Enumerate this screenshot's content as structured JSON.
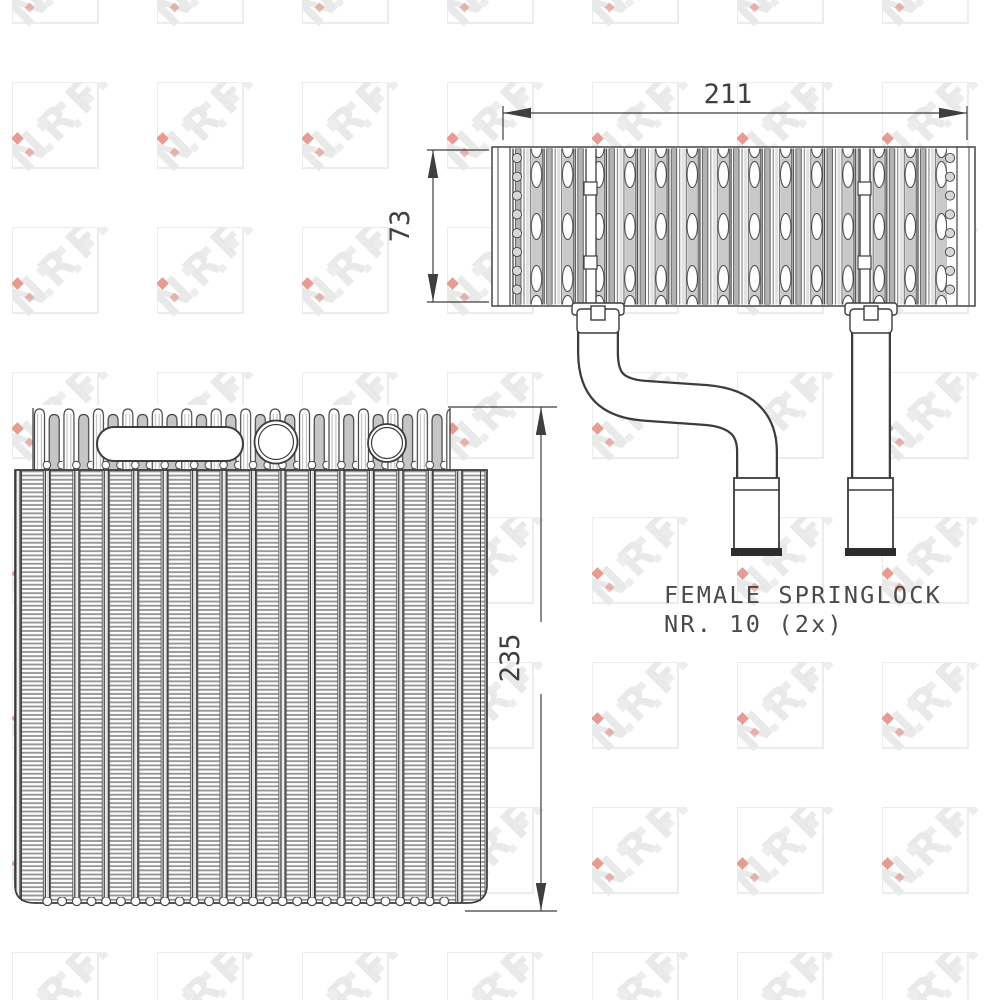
{
  "drawing": {
    "type": "technical-drawing",
    "part": "evaporator-core",
    "views": [
      "top-view",
      "front-view"
    ]
  },
  "watermark": {
    "text": "NRF",
    "square_color": "#ececec",
    "letter_color": "#e9e9e9",
    "accent_color": "#dd7a6e"
  },
  "dimensions": {
    "top_width": {
      "value": "211"
    },
    "top_depth": {
      "value": "73"
    },
    "front_height": {
      "value": "235"
    }
  },
  "annotation": {
    "line1": "FEMALE SPRINGLOCK",
    "line2": "NR. 10 (2x)"
  },
  "colors": {
    "line": "#3c3c3c",
    "fin_gray": "#969696",
    "tube_gray": "#b3b3b3",
    "background": "#ffffff"
  }
}
